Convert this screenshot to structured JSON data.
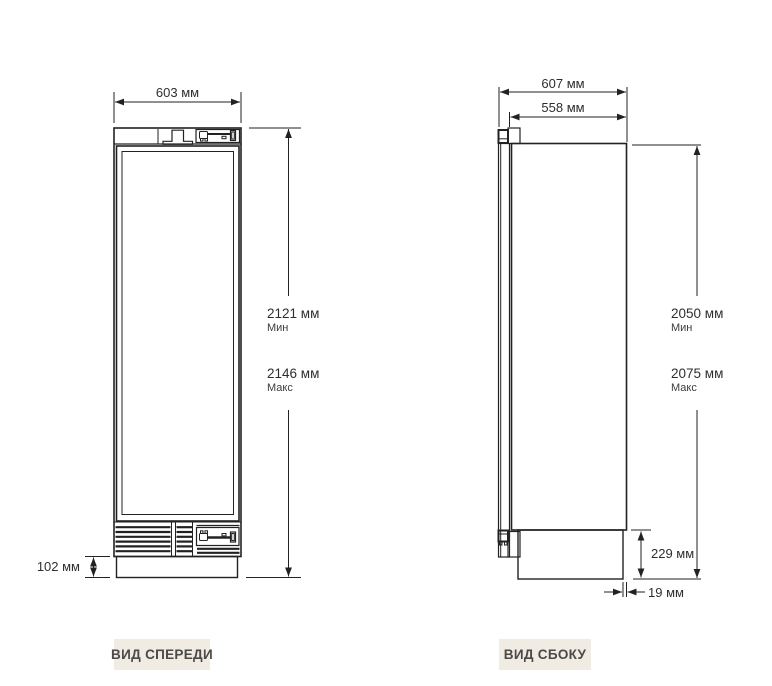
{
  "front_view": {
    "label": "ВИД СПЕРЕДИ",
    "width": "603 мм",
    "height_min": "2121 мм",
    "height_min_note": "Мин",
    "height_max": "2146 мм",
    "height_max_note": "Макс",
    "plinth_height": "102 мм"
  },
  "side_view": {
    "label": "ВИД СБОКУ",
    "depth_with_door": "607 мм",
    "depth_body": "558 мм",
    "height_min": "2050 мм",
    "height_min_note": "Мин",
    "height_max": "2075 мм",
    "height_max_note": "Макс",
    "base_height": "229 мм",
    "base_back_offset": "19 мм"
  },
  "colors": {
    "line": "#222222",
    "dim_text": "#2e2e2e",
    "note_text": "#3c3c3c",
    "label_bg": "#f0ebe3",
    "label_text": "#4b4a47"
  }
}
